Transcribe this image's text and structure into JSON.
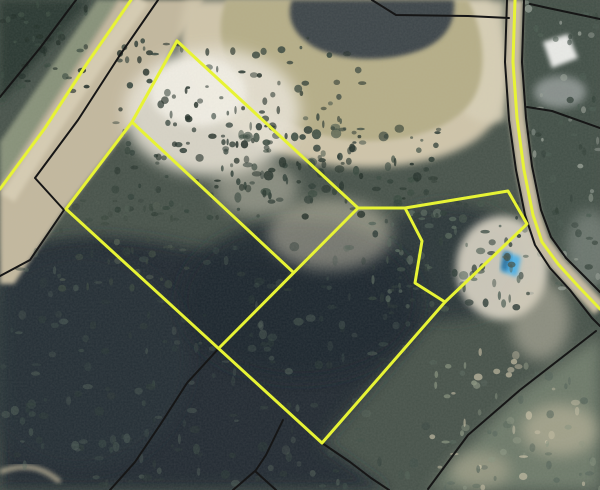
{
  "app": {
    "title": "Aerial parcel map view",
    "canvas": {
      "width": 600,
      "height": 490
    }
  },
  "map": {
    "kind": "satellite-imagery-with-parcel-overlay",
    "visible_text": [],
    "colors": {
      "highlight_parcel_line": "#e7f335",
      "county_parcel_line": "#161616",
      "deep_pond_water": "#3d4448",
      "shallow_pond_water": "#b6ae88",
      "pond_sand_bank": "#cfc5aa",
      "cleared_sand": "#e9e4d6",
      "road_surface": "#c3b89e",
      "forest_dark": "#202b31",
      "forest_green": "#435047",
      "scrub_green": "#6e7a6a",
      "blue_structure": "#4fb1e6",
      "white_building": "#e9eae7"
    },
    "features": {
      "pond": "retention pond with sandy bank, upper center",
      "road_northwest": "dirt/paved road running diagonally, upper left",
      "road_east": "road running along right side",
      "buildings_northeast": "white-roofed structure and driveways east of road",
      "blue_structure": "small blue-roofed object on sand, right of center",
      "forest_wetland": "dark wooded wetland across lower half",
      "trail_southwest": "faint dirt trail, bottom left corner"
    },
    "highlight_lines_yellow": {
      "main_parcel_outline": [
        [
          177,
          41
        ],
        [
          358,
          208
        ],
        [
          405,
          208
        ],
        [
          422,
          241
        ],
        [
          415,
          283
        ],
        [
          445,
          302
        ],
        [
          322,
          443
        ],
        [
          66,
          209
        ],
        [
          132,
          122
        ],
        [
          177,
          41
        ]
      ],
      "east_parcel_outline": [
        [
          405,
          208
        ],
        [
          508,
          191
        ],
        [
          527,
          224
        ],
        [
          445,
          302
        ]
      ],
      "interior_division_a": [
        [
          132,
          122
        ],
        [
          293,
          272
        ]
      ],
      "interior_division_b": [
        [
          358,
          208
        ],
        [
          220,
          347
        ]
      ],
      "road_edge_northwest": [
        [
          131,
          0
        ],
        [
          88,
          62
        ],
        [
          45,
          128
        ],
        [
          0,
          189
        ]
      ],
      "road_line_east": [
        [
          515,
          0
        ],
        [
          513,
          62
        ],
        [
          517,
          118
        ],
        [
          524,
          170
        ],
        [
          533,
          215
        ],
        [
          542,
          242
        ],
        [
          558,
          264
        ],
        [
          578,
          286
        ],
        [
          600,
          309
        ]
      ]
    },
    "parcel_lines_black": {
      "west_forest_line": [
        [
          76,
          0
        ],
        [
          40,
          48
        ],
        [
          0,
          97
        ]
      ],
      "road_east_edge_with_jog": [
        [
          158,
          0
        ],
        [
          120,
          55
        ],
        [
          78,
          120
        ],
        [
          35,
          178
        ],
        [
          64,
          210
        ],
        [
          30,
          260
        ],
        [
          0,
          276
        ]
      ],
      "pond_north_line": [
        [
          372,
          0
        ],
        [
          396,
          15
        ],
        [
          468,
          16
        ],
        [
          509,
          18
        ]
      ],
      "east_road_west_edge": [
        [
          507,
          0
        ],
        [
          505,
          62
        ],
        [
          509,
          120
        ],
        [
          516,
          170
        ],
        [
          525,
          215
        ],
        [
          535,
          245
        ],
        [
          550,
          268
        ],
        [
          570,
          290
        ],
        [
          592,
          318
        ],
        [
          600,
          326
        ]
      ],
      "east_road_east_edge": [
        [
          524,
          0
        ],
        [
          522,
          62
        ],
        [
          526,
          118
        ],
        [
          532,
          166
        ],
        [
          541,
          210
        ],
        [
          551,
          237
        ],
        [
          566,
          258
        ],
        [
          586,
          278
        ],
        [
          600,
          292
        ]
      ],
      "northeast_branch_upper": [
        [
          530,
          4
        ],
        [
          548,
          8
        ],
        [
          600,
          19
        ]
      ],
      "northeast_branch_lower": [
        [
          527,
          107
        ],
        [
          552,
          111
        ],
        [
          600,
          128
        ]
      ],
      "southeast_diagonal": [
        [
          596,
          331
        ],
        [
          520,
          390
        ],
        [
          468,
          435
        ],
        [
          428,
          489
        ]
      ],
      "south_corner_extension": [
        [
          322,
          443
        ],
        [
          350,
          462
        ],
        [
          371,
          478
        ],
        [
          389,
          490
        ]
      ],
      "southwest_extension": [
        [
          220,
          347
        ],
        [
          187,
          383
        ],
        [
          160,
          425
        ],
        [
          135,
          462
        ],
        [
          110,
          490
        ]
      ],
      "bottom_peak_left": [
        [
          233,
          490
        ],
        [
          255,
          471
        ],
        [
          276,
          490
        ]
      ],
      "bottom_peak_stub": [
        [
          283,
          420
        ],
        [
          266,
          455
        ],
        [
          256,
          470
        ]
      ]
    }
  }
}
